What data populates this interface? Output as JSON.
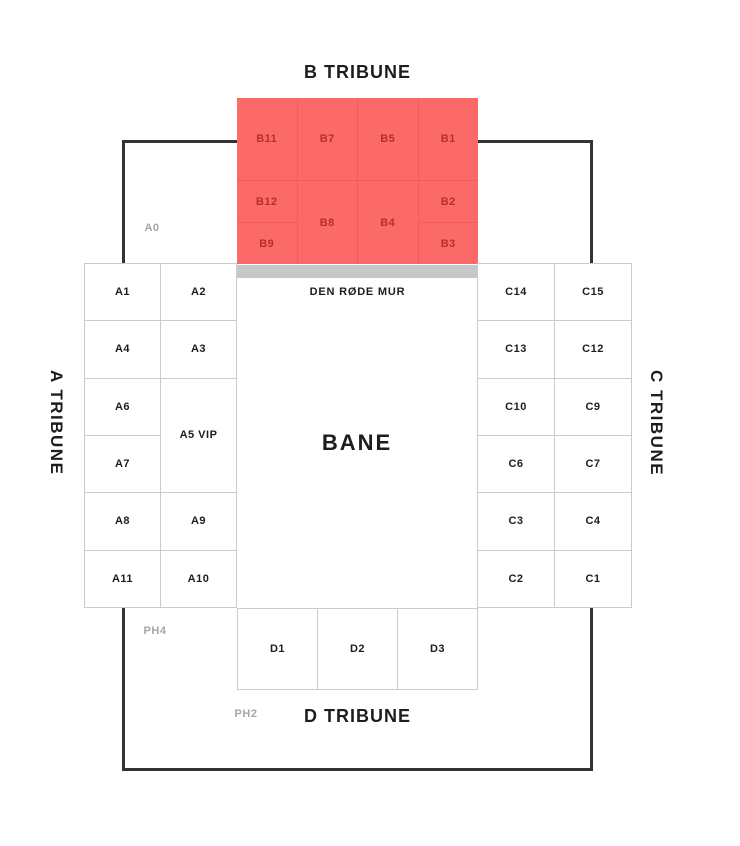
{
  "titles": {
    "b_tribune": "B TRIBUNE",
    "a_tribune": "A TRIBUNE",
    "c_tribune": "C TRIBUNE",
    "d_tribune": "D TRIBUNE"
  },
  "pitch_label": "BANE",
  "red_wall_label": "DEN RØDE MUR",
  "area_labels": {
    "a0": "A0",
    "ph4": "PH4",
    "ph2": "PH2"
  },
  "sections": {
    "b": [
      "B11",
      "B7",
      "B5",
      "B1",
      "B12",
      "B8",
      "B4",
      "B2",
      "B9",
      "B3"
    ],
    "a": [
      "A1",
      "A2",
      "A4",
      "A3",
      "A6",
      "A5 VIP",
      "A7",
      "A8",
      "A9",
      "A11",
      "A10"
    ],
    "c": [
      "C14",
      "C15",
      "C13",
      "C12",
      "C10",
      "C9",
      "C6",
      "C7",
      "C3",
      "C4",
      "C2",
      "C1"
    ],
    "d": [
      "D1",
      "D2",
      "D3"
    ]
  },
  "colors": {
    "bg": "#ffffff",
    "red": "#fb6a68",
    "red-border": "#f15d5b",
    "red-text": "#b92d2a",
    "gray-bar": "#c7c7c7",
    "cell-border": "#cccccc",
    "outer-border": "#333333",
    "text": "#1d1d1d",
    "muted": "#a6a6a6"
  }
}
